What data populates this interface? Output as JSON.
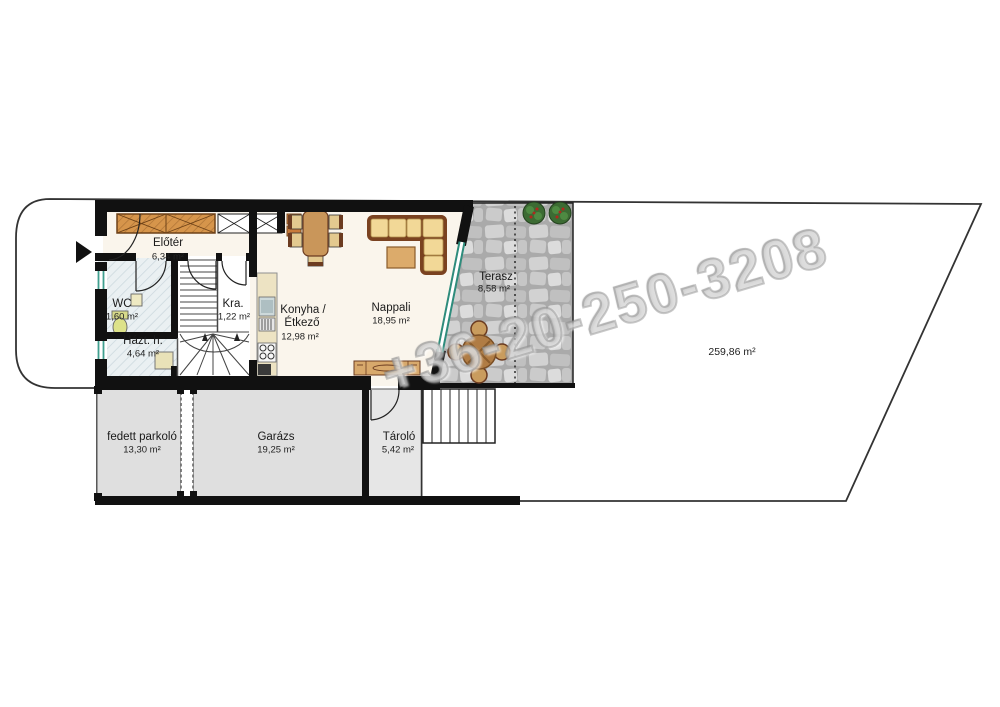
{
  "watermark": "+36-20-250-3208",
  "plot": {
    "area_label": "259,86 m²"
  },
  "rooms": [
    {
      "id": "elotere",
      "name": "Előtér",
      "area": "6,34 m²"
    },
    {
      "id": "wc",
      "name": "WC",
      "area": "1,60 m²"
    },
    {
      "id": "hazt",
      "name": "Házt. h.",
      "area": "4,64 m²"
    },
    {
      "id": "kra",
      "name": "Kra.",
      "area": "1,22 m²"
    },
    {
      "id": "konyha",
      "name": "Konyha /",
      "name2": "Étkező",
      "area": "12,98 m²"
    },
    {
      "id": "nappali",
      "name": "Nappali",
      "area": "18,95 m²"
    },
    {
      "id": "terasz",
      "name": "Terasz",
      "area": "8,58 m²"
    },
    {
      "id": "parkolo",
      "name": "fedett parkoló",
      "area": "13,30 m²"
    },
    {
      "id": "garazs",
      "name": "Garázs",
      "area": "19,25 m²"
    },
    {
      "id": "tarolo",
      "name": "Tároló",
      "area": "5,42 m²"
    }
  ],
  "colors": {
    "wall": "#111111",
    "room_cream": "#faf5ec",
    "tile_room": "#eaf0f2",
    "garage_gray": "#dfdfdf",
    "wood_dark": "#6b3b20",
    "wood_mid": "#c9965a",
    "cushion_tan": "#f2d897",
    "wardrobe_orange": "#d6954b",
    "glass_teal": "#3f9f8f",
    "stone_gray": "#c4c4c4",
    "bush_green": "#3c6b33",
    "watermark_gray": "#bcbcbc"
  }
}
